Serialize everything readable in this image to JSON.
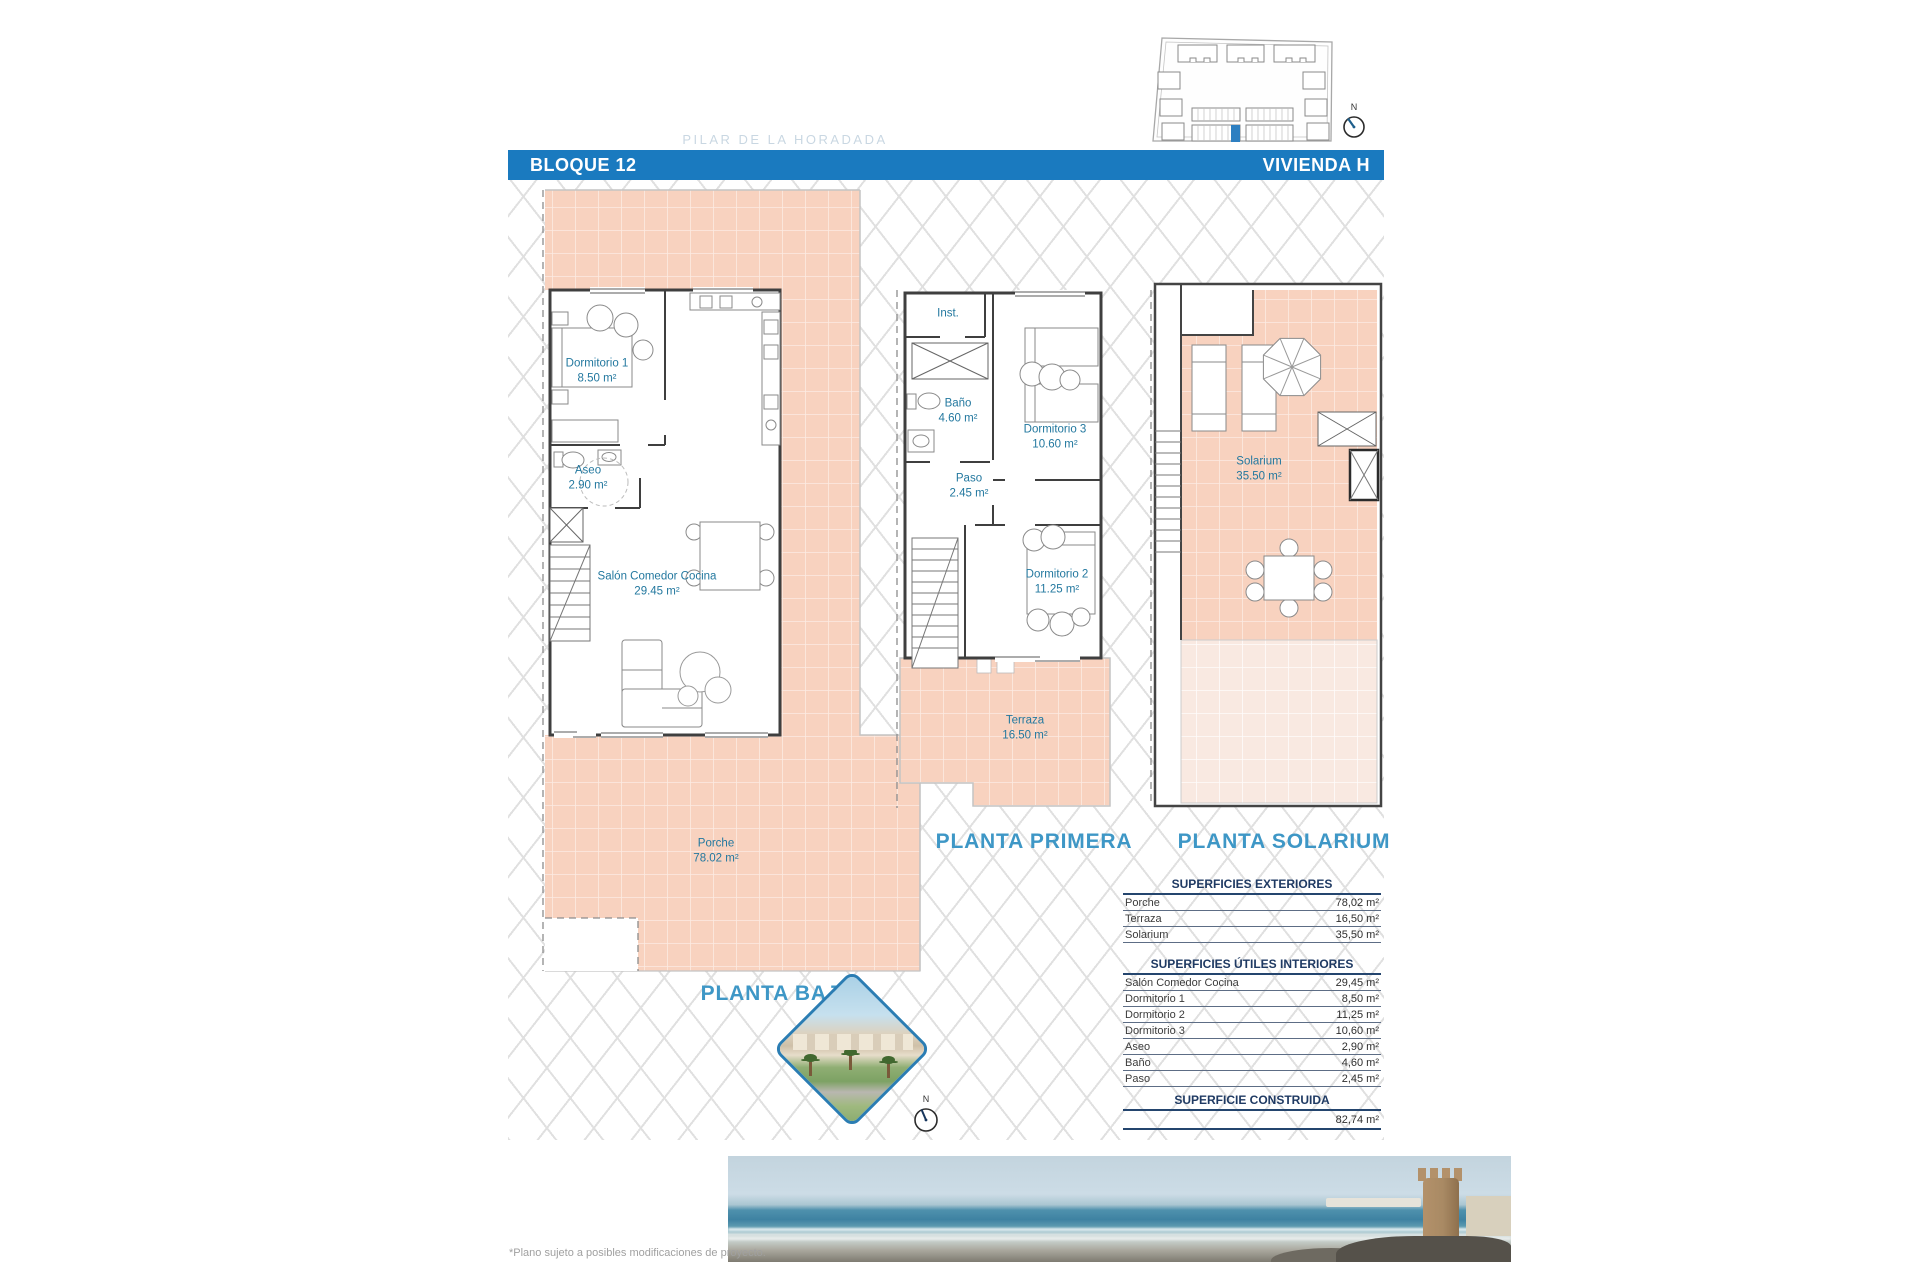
{
  "header": {
    "block": "BLOQUE 12",
    "unit": "VIVIENDA H",
    "watermark": "PILAR DE LA HORADADA"
  },
  "compass": {
    "label": "N"
  },
  "plans": {
    "baja": {
      "title": "PLANTA BAJA",
      "rooms": [
        {
          "name": "Dormitorio 1",
          "area": "8.50 m²"
        },
        {
          "name": "Aseo",
          "area": "2.90 m²"
        },
        {
          "name": "Salón Comedor Cocina",
          "area": "29.45 m²"
        },
        {
          "name": "Porche",
          "area": "78.02 m²"
        }
      ]
    },
    "primera": {
      "title": "PLANTA PRIMERA",
      "rooms": [
        {
          "name": "Inst.",
          "area": ""
        },
        {
          "name": "Baño",
          "area": "4.60 m²"
        },
        {
          "name": "Dormitorio 3",
          "area": "10.60 m²"
        },
        {
          "name": "Paso",
          "area": "2.45 m²"
        },
        {
          "name": "Dormitorio 2",
          "area": "11.25 m²"
        },
        {
          "name": "Terraza",
          "area": "16.50 m²"
        }
      ]
    },
    "solarium": {
      "title": "PLANTA SOLARIUM",
      "rooms": [
        {
          "name": "Solarium",
          "area": "35.50 m²"
        }
      ]
    }
  },
  "tables": {
    "exteriores": {
      "title": "SUPERFICIES EXTERIORES",
      "rows": [
        {
          "label": "Porche",
          "value": "78,02 m²"
        },
        {
          "label": "Terraza",
          "value": "16,50 m²"
        },
        {
          "label": "Solarium",
          "value": "35,50 m²"
        }
      ]
    },
    "interiores": {
      "title": "SUPERFICIES ÚTILES INTERIORES",
      "rows": [
        {
          "label": "Salón Comedor Cocina",
          "value": "29,45 m²"
        },
        {
          "label": "Dormitorio 1",
          "value": "8,50 m²"
        },
        {
          "label": "Dormitorio 2",
          "value": "11,25 m²"
        },
        {
          "label": "Dormitorio 3",
          "value": "10,60 m²"
        },
        {
          "label": "Aseo",
          "value": "2,90 m²"
        },
        {
          "label": "Baño",
          "value": "4,60 m²"
        },
        {
          "label": "Paso",
          "value": "2,45 m²"
        }
      ]
    },
    "construida": {
      "title": "SUPERFICIE CONSTRUIDA",
      "value": "82,74 m²"
    }
  },
  "footer": {
    "note": "*Plano sujeto a posibles modificaciones de proyecto."
  },
  "colors": {
    "accent_blue": "#1a7abf",
    "tile_pink": "#f8d2bf",
    "label_teal": "#23789f",
    "title_blue": "#3e97c6",
    "table_navy": "#1f3a63",
    "highlight_unit_blue": "#2d7fc1"
  }
}
